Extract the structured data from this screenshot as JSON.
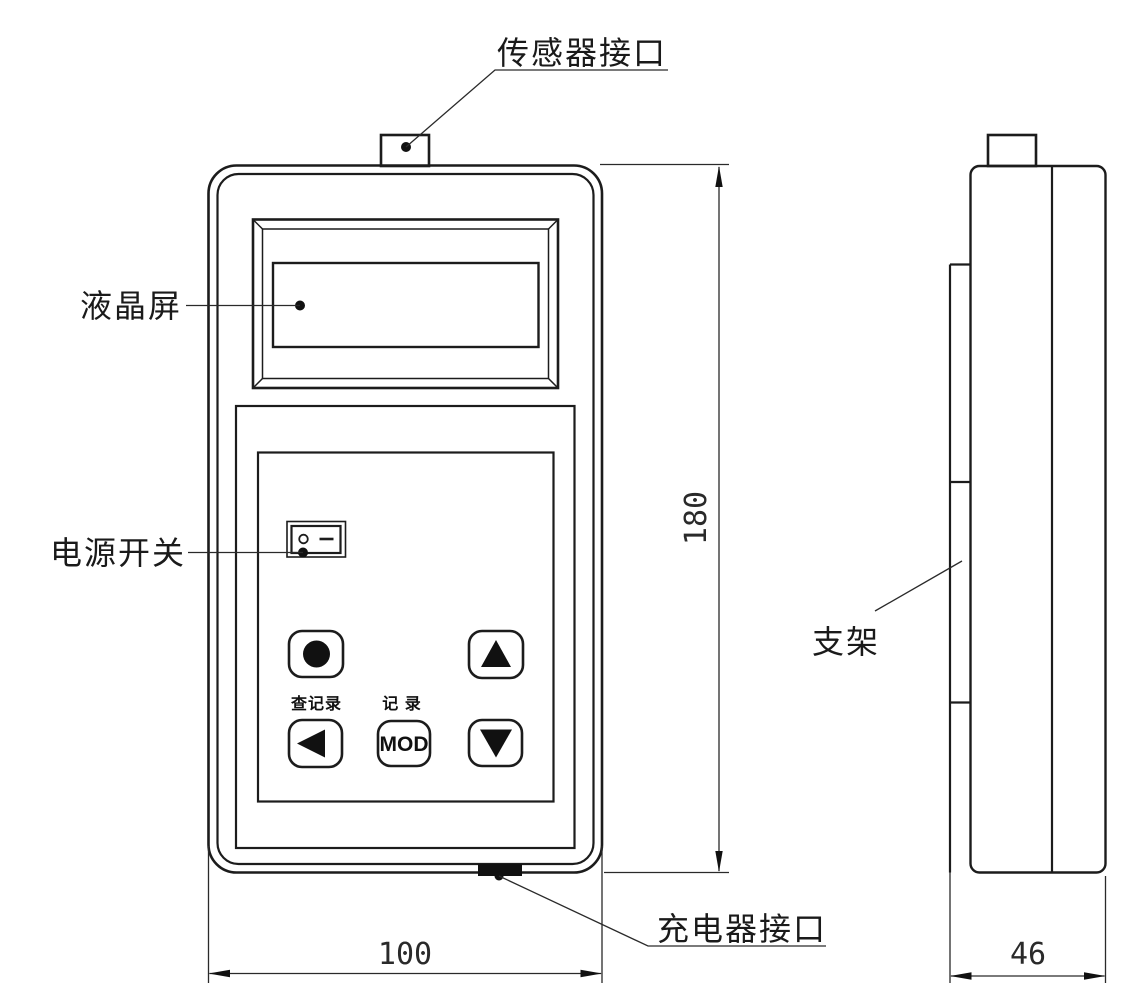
{
  "document": {
    "type": "technical-drawing",
    "background": "#ffffff",
    "line_color": "#1c1c1c"
  },
  "front_view": {
    "callouts": {
      "sensor_port": "传感器接口",
      "lcd_screen": "液晶屏",
      "power_switch": "电源开关",
      "charger_port": "充电器接口"
    },
    "keypad": {
      "view_record_label": "查记录",
      "record_label": "记 录",
      "mod_button": "MOD"
    },
    "dimensions": {
      "height_mm": "180",
      "width_mm": "100"
    }
  },
  "side_view": {
    "callouts": {
      "bracket": "支架"
    },
    "dimensions": {
      "depth_mm": "46"
    }
  }
}
